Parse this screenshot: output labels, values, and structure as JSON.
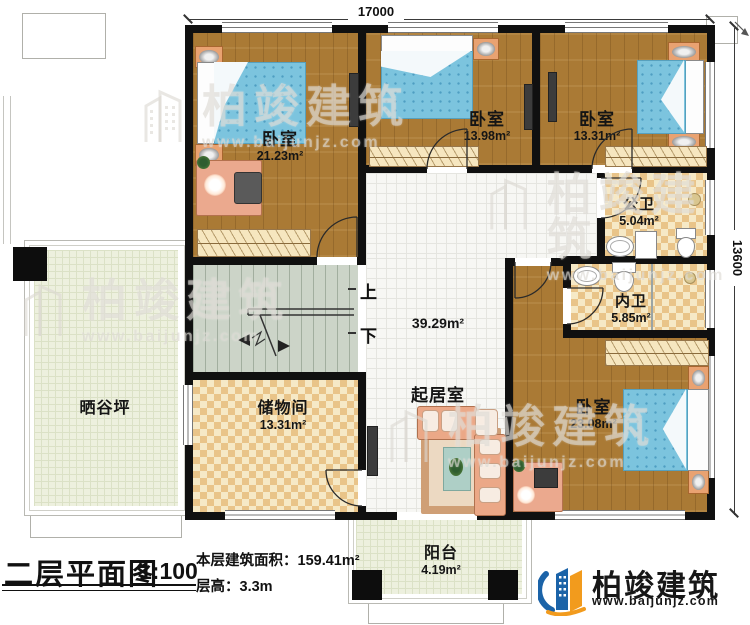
{
  "plan": {
    "dimension_top": "17000",
    "dimension_right": "13600",
    "stairs_up": "上",
    "stairs_down": "下",
    "rooms": {
      "bedroom_tl": {
        "label": "卧室",
        "area": "21.23m²"
      },
      "bedroom_tm": {
        "label": "卧室",
        "area": "13.98m²"
      },
      "bedroom_tr": {
        "label": "卧室",
        "area": "13.31m²"
      },
      "public_bath": {
        "label": "公卫",
        "area": "5.04m²"
      },
      "inner_bath": {
        "label": "内卫",
        "area": "5.85m²"
      },
      "bedroom_br": {
        "label": "卧室",
        "area": "23.08m²"
      },
      "living": {
        "label": "起居室",
        "area": "39.29m²"
      },
      "storage": {
        "label": "储物间",
        "area": "13.31m²"
      },
      "drying_yard": {
        "label": "晒谷坪"
      },
      "balcony": {
        "label": "阳台",
        "area": "4.19m²"
      }
    }
  },
  "titleblock": {
    "title": "二层平面图",
    "scale": "1:100",
    "floor_area": "本层建筑面积：159.41m²",
    "floor_height": "层高：3.3m"
  },
  "brand": {
    "name": "柏竣建筑",
    "website": "www.baijunjz.com"
  },
  "watermark": {
    "name": "柏竣建筑",
    "website": "www.baijunjz.com"
  },
  "colors": {
    "wall": "#101010",
    "wood_floor": "#aa7a35",
    "tile_accent": "#e9c489",
    "bed_blue": "#7cc4de",
    "brand_blue": "#1b63a8",
    "brand_orange": "#f29b1d"
  }
}
